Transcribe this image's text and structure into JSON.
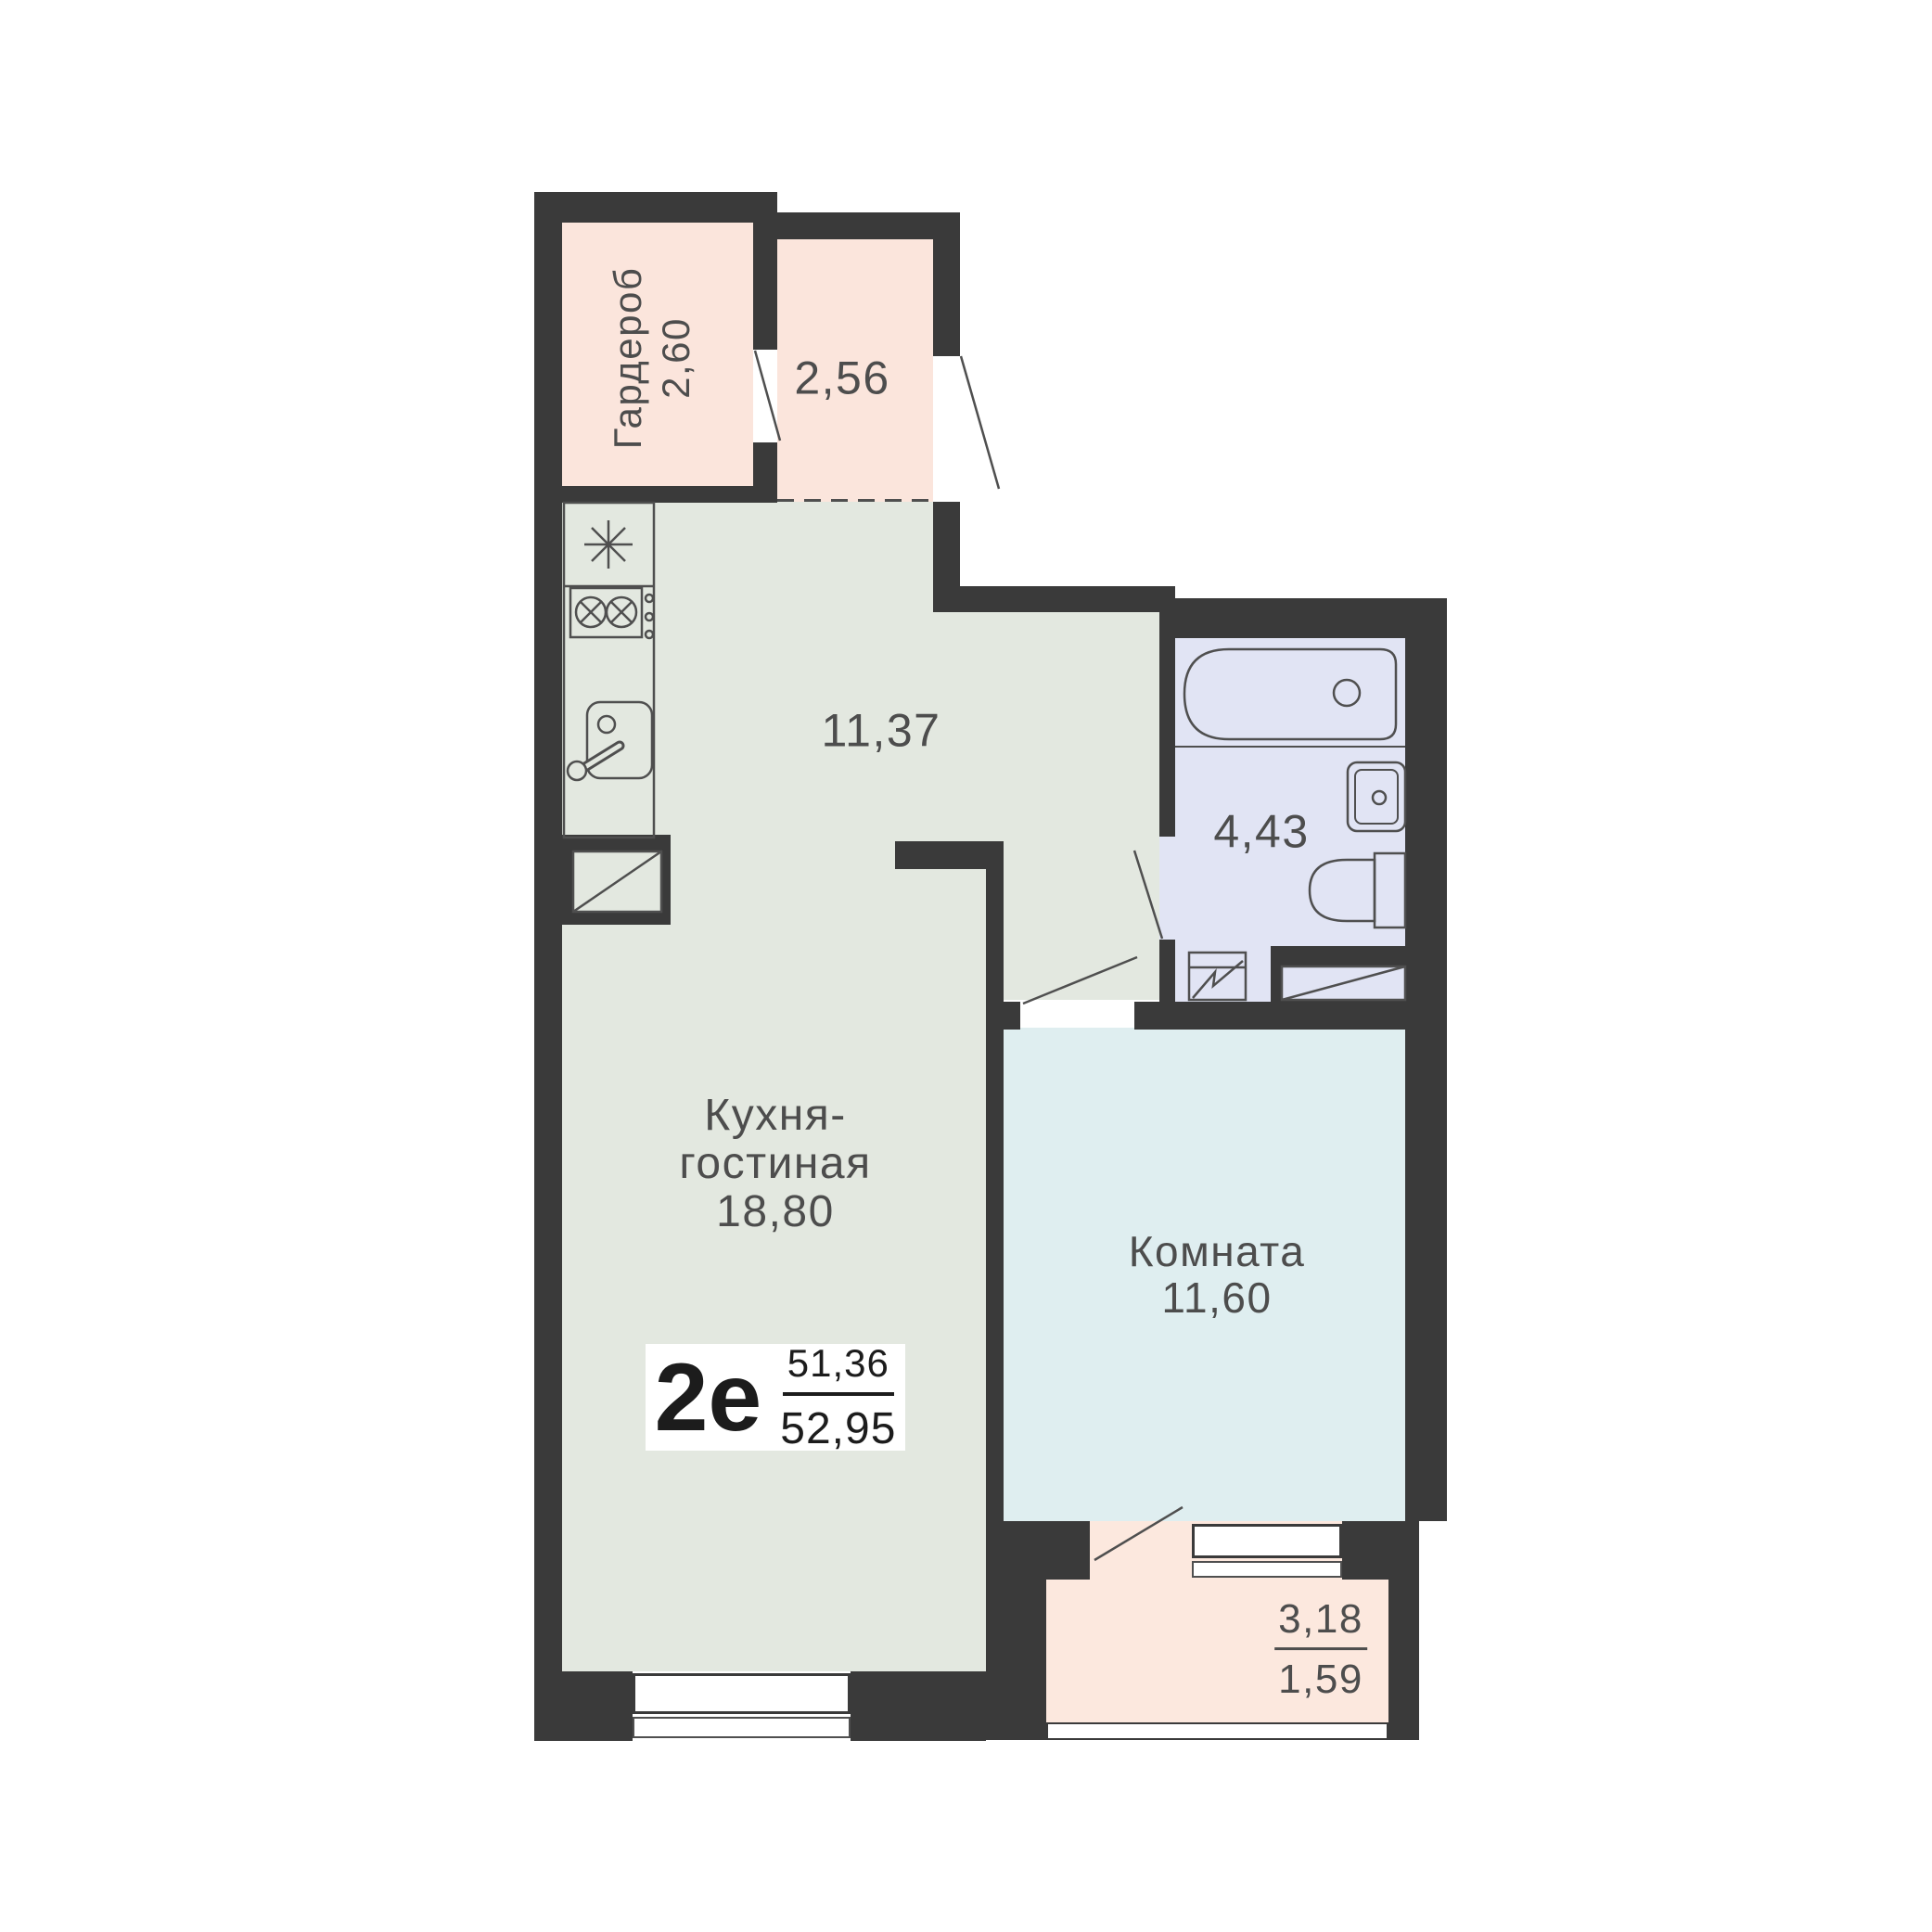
{
  "plan_type": {
    "code": "2е",
    "upper_area": "51,36",
    "lower_area": "52,95"
  },
  "rooms": {
    "wardrobe": {
      "name": "Гардероб",
      "area": "2,60"
    },
    "hallway": {
      "area": "2,56"
    },
    "corridor": {
      "area": "11,37"
    },
    "bathroom": {
      "area": "4,43"
    },
    "kitchen_living": {
      "name_line1": "Кухня-",
      "name_line2": "гостиная",
      "area": "18,80"
    },
    "room": {
      "name": "Комната",
      "area": "11,60"
    },
    "balcony": {
      "area_total": "3,18",
      "area_counted": "1,59"
    }
  },
  "colors": {
    "wall": "#3a3a3a",
    "outline": "#4f4f4f",
    "label_text": "#4d4d4d",
    "type_text": "#1c1c1c",
    "wardrobe_fill": "#fbe5dc",
    "hallway_fill": "#fbe5dc",
    "kitchen_fill": "#e3e8e0",
    "bathroom_fill": "#e1e4f4",
    "room_fill": "#dfeef0",
    "balcony_fill": "#fce8de",
    "background": "#ffffff"
  }
}
